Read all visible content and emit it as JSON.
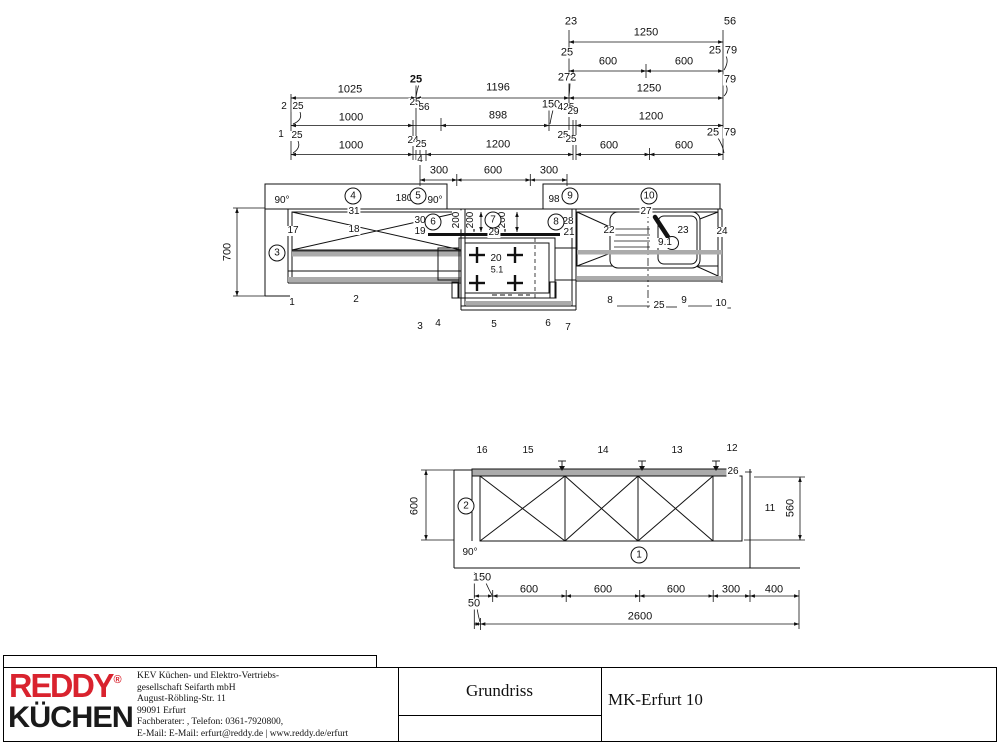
{
  "sheet": {
    "colors": {
      "line": "#111111",
      "gray_fill": "#ababab",
      "logo_red": "#d9232e",
      "logo_black": "#1a1a1a"
    }
  },
  "title_block": {
    "project_title": "Grundriss",
    "plan_name": "MK-Erfurt 10",
    "logo": {
      "line1": "REDDY",
      "reg": "®",
      "line2": "KÜCHEN"
    },
    "company_lines": [
      "KEV Küchen- und Elektro-Vertriebs-",
      "gesellschaft Seifarth mbH",
      "August-Röbling-Str. 11",
      "99091 Erfurt",
      "Fachberater: , Telefon: 0361-7920800,",
      "E-Mail: E-Mail: erfurt@reddy.de | www.reddy.de/erfurt"
    ]
  },
  "plan_view": {
    "dim_texts": [
      {
        "t": "23",
        "x": 571,
        "y": 22
      },
      {
        "t": "56",
        "x": 730,
        "y": 22
      },
      {
        "t": "1250",
        "x": 646,
        "y": 33
      },
      {
        "t": "25",
        "x": 567,
        "y": 53
      },
      {
        "t": "25",
        "x": 715,
        "y": 51
      },
      {
        "t": "79",
        "x": 731,
        "y": 51
      },
      {
        "t": "600",
        "x": 608,
        "y": 62
      },
      {
        "t": "600",
        "x": 684,
        "y": 62
      },
      {
        "t": "272",
        "x": 567,
        "y": 78
      },
      {
        "t": "79",
        "x": 730,
        "y": 80
      },
      {
        "t": "1250",
        "x": 649,
        "y": 89
      },
      {
        "t": "25",
        "x": 416,
        "y": 80,
        "b": 1
      },
      {
        "t": "1025",
        "x": 350,
        "y": 90
      },
      {
        "t": "1196",
        "x": 498,
        "y": 88
      },
      {
        "t": "2",
        "x": 284,
        "y": 107,
        "s": 10
      },
      {
        "t": "25",
        "x": 298,
        "y": 107,
        "s": 10
      },
      {
        "t": "1000",
        "x": 351,
        "y": 118
      },
      {
        "t": "25",
        "x": 415,
        "y": 103,
        "s": 10
      },
      {
        "t": "56",
        "x": 424,
        "y": 108,
        "s": 10
      },
      {
        "t": "898",
        "x": 498,
        "y": 116
      },
      {
        "t": "150",
        "x": 551,
        "y": 105
      },
      {
        "t": "425",
        "x": 566,
        "y": 108,
        "s": 10
      },
      {
        "t": "29",
        "x": 573,
        "y": 112,
        "s": 10
      },
      {
        "t": "1200",
        "x": 651,
        "y": 117
      },
      {
        "t": "1",
        "x": 281,
        "y": 135,
        "s": 10
      },
      {
        "t": "25",
        "x": 297,
        "y": 136,
        "s": 10
      },
      {
        "t": "1000",
        "x": 351,
        "y": 146
      },
      {
        "t": "24",
        "x": 413,
        "y": 141,
        "s": 10
      },
      {
        "t": "25",
        "x": 421,
        "y": 145,
        "s": 10
      },
      {
        "t": "1200",
        "x": 498,
        "y": 145
      },
      {
        "t": "25",
        "x": 563,
        "y": 136,
        "s": 10
      },
      {
        "t": "25",
        "x": 571,
        "y": 140,
        "s": 10
      },
      {
        "t": "600",
        "x": 609,
        "y": 146
      },
      {
        "t": "600",
        "x": 684,
        "y": 146
      },
      {
        "t": "25",
        "x": 713,
        "y": 133
      },
      {
        "t": "79",
        "x": 730,
        "y": 133
      },
      {
        "t": "4",
        "x": 420,
        "y": 160,
        "s": 10
      },
      {
        "t": "300",
        "x": 439,
        "y": 171
      },
      {
        "t": "600",
        "x": 493,
        "y": 171
      },
      {
        "t": "300",
        "x": 549,
        "y": 171
      },
      {
        "t": "700",
        "x": 228,
        "y": 252,
        "rot": 1
      },
      {
        "t": "200",
        "x": 457,
        "y": 220,
        "rot": 1,
        "s": 10
      },
      {
        "t": "200",
        "x": 471,
        "y": 220,
        "rot": 1,
        "s": 10
      },
      {
        "t": "200",
        "x": 503,
        "y": 220,
        "rot": 1,
        "s": 10
      }
    ],
    "item_texts": [
      {
        "t": "90°",
        "x": 282,
        "y": 201
      },
      {
        "t": "31",
        "x": 354,
        "y": 212
      },
      {
        "t": "180",
        "x": 404,
        "y": 199
      },
      {
        "t": "90°",
        "x": 435,
        "y": 201
      },
      {
        "t": "98",
        "x": 554,
        "y": 200
      },
      {
        "t": "27",
        "x": 646,
        "y": 212
      },
      {
        "t": "17",
        "x": 293,
        "y": 231
      },
      {
        "t": "18",
        "x": 354,
        "y": 230
      },
      {
        "t": "30",
        "x": 420,
        "y": 221
      },
      {
        "t": "19",
        "x": 420,
        "y": 232
      },
      {
        "t": "29",
        "x": 494,
        "y": 233
      },
      {
        "t": "28",
        "x": 568,
        "y": 222
      },
      {
        "t": "21",
        "x": 569,
        "y": 233
      },
      {
        "t": "22",
        "x": 609,
        "y": 231
      },
      {
        "t": "23",
        "x": 683,
        "y": 231
      },
      {
        "t": "9.1",
        "x": 665,
        "y": 243
      },
      {
        "t": "24",
        "x": 722,
        "y": 232
      },
      {
        "t": "20",
        "x": 496,
        "y": 259
      },
      {
        "t": "5.1",
        "x": 497,
        "y": 270,
        "s": 9
      },
      {
        "t": "1",
        "x": 292,
        "y": 303
      },
      {
        "t": "2",
        "x": 356,
        "y": 300
      },
      {
        "t": "3",
        "x": 420,
        "y": 327
      },
      {
        "t": "4",
        "x": 438,
        "y": 324
      },
      {
        "t": "5",
        "x": 494,
        "y": 325
      },
      {
        "t": "6",
        "x": 548,
        "y": 324
      },
      {
        "t": "7",
        "x": 568,
        "y": 328
      },
      {
        "t": "8",
        "x": 610,
        "y": 301
      },
      {
        "t": "25",
        "x": 659,
        "y": 306
      },
      {
        "t": "9",
        "x": 684,
        "y": 301
      },
      {
        "t": "10",
        "x": 721,
        "y": 304
      }
    ],
    "circles": [
      {
        "n": "4",
        "x": 353,
        "y": 196
      },
      {
        "n": "5",
        "x": 418,
        "y": 196
      },
      {
        "n": "9",
        "x": 570,
        "y": 196
      },
      {
        "n": "10",
        "x": 649,
        "y": 196
      },
      {
        "n": "3",
        "x": 277,
        "y": 253
      },
      {
        "n": "6",
        "x": 433,
        "y": 222
      },
      {
        "n": "7",
        "x": 493,
        "y": 220
      },
      {
        "n": "8",
        "x": 556,
        "y": 222
      }
    ]
  },
  "elevation_view": {
    "dim_texts": [
      {
        "t": "600",
        "x": 415,
        "y": 506,
        "rot": 1
      },
      {
        "t": "560",
        "x": 791,
        "y": 508,
        "rot": 1
      },
      {
        "t": "150",
        "x": 482,
        "y": 578
      },
      {
        "t": "600",
        "x": 529,
        "y": 590
      },
      {
        "t": "600",
        "x": 603,
        "y": 590
      },
      {
        "t": "600",
        "x": 676,
        "y": 590
      },
      {
        "t": "300",
        "x": 731,
        "y": 590
      },
      {
        "t": "400",
        "x": 774,
        "y": 590
      },
      {
        "t": "50",
        "x": 474,
        "y": 604
      },
      {
        "t": "2600",
        "x": 640,
        "y": 617
      }
    ],
    "item_texts": [
      {
        "t": "16",
        "x": 482,
        "y": 451
      },
      {
        "t": "15",
        "x": 528,
        "y": 451
      },
      {
        "t": "14",
        "x": 603,
        "y": 451
      },
      {
        "t": "13",
        "x": 677,
        "y": 451
      },
      {
        "t": "12",
        "x": 732,
        "y": 449
      },
      {
        "t": "26",
        "x": 733,
        "y": 472
      },
      {
        "t": "11",
        "x": 770,
        "y": 509
      },
      {
        "t": "90°",
        "x": 470,
        "y": 553
      }
    ],
    "circles": [
      {
        "n": "2",
        "x": 466,
        "y": 506
      },
      {
        "n": "1",
        "x": 639,
        "y": 555
      }
    ]
  }
}
